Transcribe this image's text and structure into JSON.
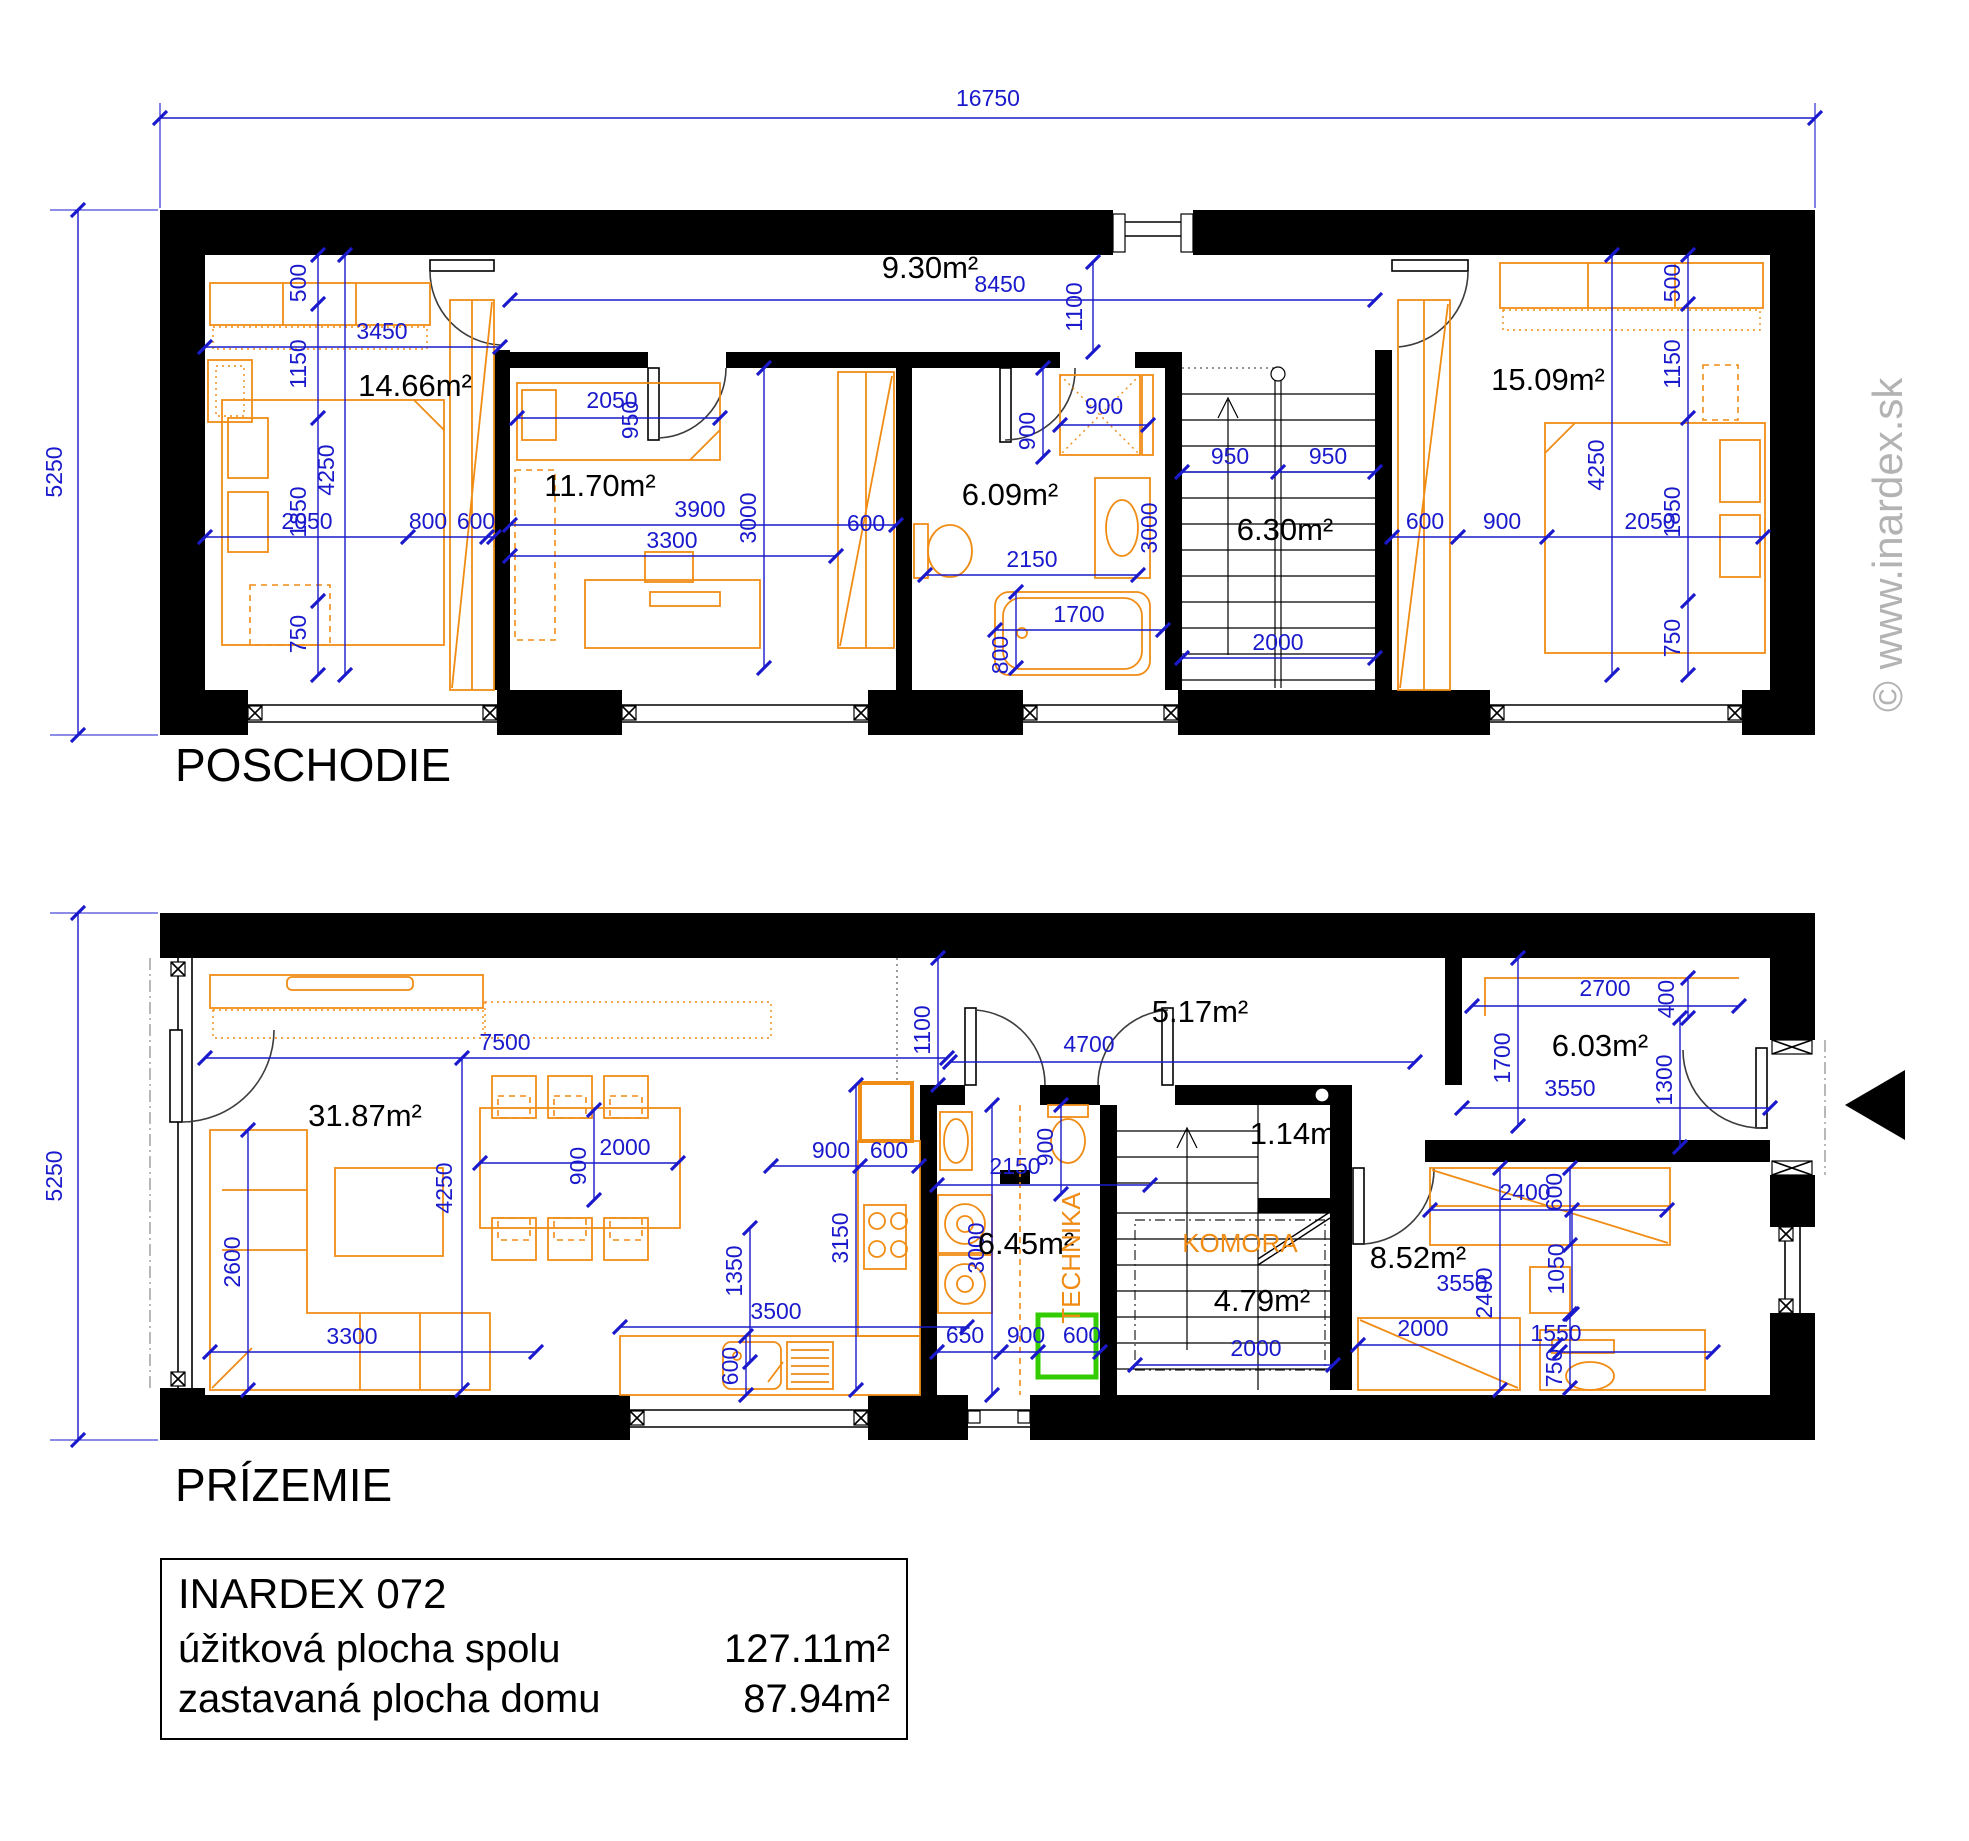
{
  "page": {
    "watermark": "© www.inardex.sk",
    "colors": {
      "dimension_blue": "#1a1acc",
      "furniture_orange": "#f08c14",
      "highlight_green": "#33cc00",
      "wall_black": "#000000",
      "watermark_gray": "#b3b3b3"
    }
  },
  "title_block": {
    "project": "INARDEX 072",
    "rows": [
      {
        "label": "úžitková plocha spolu",
        "value": "127.11m²"
      },
      {
        "label": "zastavaná plocha domu",
        "value": "87.94m²"
      }
    ]
  },
  "floors": [
    {
      "name": "POSCHODIE",
      "overall_width": "16750",
      "overall_depth": "5250",
      "area_labels": [
        {
          "t": "14.66m²",
          "x": 415,
          "y": 396
        },
        {
          "t": "9.30m²",
          "x": 930,
          "y": 278
        },
        {
          "t": "11.70m²",
          "x": 600,
          "y": 496
        },
        {
          "t": "6.09m²",
          "x": 1010,
          "y": 505
        },
        {
          "t": "6.30m²",
          "x": 1285,
          "y": 540
        },
        {
          "t": "15.09m²",
          "x": 1548,
          "y": 390
        }
      ],
      "dim_labels": [
        {
          "t": "16750",
          "x": 988,
          "y": 106
        },
        {
          "t": "5250",
          "x": 62,
          "y": 472,
          "r": -90
        },
        {
          "t": "8450",
          "x": 1000,
          "y": 292
        },
        {
          "t": "1100",
          "x": 1082,
          "y": 307,
          "r": -90
        },
        {
          "t": "3450",
          "x": 382,
          "y": 339
        },
        {
          "t": "500",
          "x": 306,
          "y": 283,
          "r": -90
        },
        {
          "t": "1150",
          "x": 306,
          "y": 364,
          "r": -90
        },
        {
          "t": "4250",
          "x": 334,
          "y": 470,
          "r": -90
        },
        {
          "t": "1850",
          "x": 306,
          "y": 512,
          "r": -90
        },
        {
          "t": "750",
          "x": 306,
          "y": 634,
          "r": -90
        },
        {
          "t": "2050",
          "x": 307,
          "y": 529
        },
        {
          "t": "800",
          "x": 428,
          "y": 529
        },
        {
          "t": "600",
          "x": 476,
          "y": 529
        },
        {
          "t": "2050",
          "x": 612,
          "y": 408
        },
        {
          "t": "950",
          "x": 638,
          "y": 420,
          "r": -90
        },
        {
          "t": "3900",
          "x": 700,
          "y": 517
        },
        {
          "t": "3300",
          "x": 672,
          "y": 548
        },
        {
          "t": "3000",
          "x": 756,
          "y": 518,
          "r": -90
        },
        {
          "t": "600",
          "x": 866,
          "y": 531
        },
        {
          "t": "900",
          "x": 1104,
          "y": 414
        },
        {
          "t": "900",
          "x": 1035,
          "y": 431,
          "r": -90
        },
        {
          "t": "2150",
          "x": 1032,
          "y": 567
        },
        {
          "t": "3000",
          "x": 1157,
          "y": 528,
          "r": -90
        },
        {
          "t": "1700",
          "x": 1079,
          "y": 622
        },
        {
          "t": "800",
          "x": 1008,
          "y": 655,
          "r": -90
        },
        {
          "t": "950",
          "x": 1230,
          "y": 464
        },
        {
          "t": "950",
          "x": 1328,
          "y": 464
        },
        {
          "t": "2000",
          "x": 1278,
          "y": 650
        },
        {
          "t": "600",
          "x": 1425,
          "y": 529
        },
        {
          "t": "900",
          "x": 1502,
          "y": 529
        },
        {
          "t": "2050",
          "x": 1650,
          "y": 529
        },
        {
          "t": "4250",
          "x": 1604,
          "y": 465,
          "r": -90
        },
        {
          "t": "500",
          "x": 1680,
          "y": 283,
          "r": -90
        },
        {
          "t": "1150",
          "x": 1680,
          "y": 364,
          "r": -90
        },
        {
          "t": "1850",
          "x": 1680,
          "y": 512,
          "r": -90
        },
        {
          "t": "750",
          "x": 1680,
          "y": 638,
          "r": -90
        }
      ],
      "feature_labels": []
    },
    {
      "name": "PRÍZEMIE",
      "overall_depth": "5250",
      "area_labels": [
        {
          "t": "31.87m²",
          "x": 365,
          "y": 1126
        },
        {
          "t": "5.17m²",
          "x": 1200,
          "y": 1022
        },
        {
          "t": "6.03m²",
          "x": 1600,
          "y": 1056
        },
        {
          "t": "1.14m²",
          "x": 1298,
          "y": 1144
        },
        {
          "t": "6.45m²",
          "x": 1026,
          "y": 1254
        },
        {
          "t": "4.79m²",
          "x": 1262,
          "y": 1311
        },
        {
          "t": "8.52m²",
          "x": 1418,
          "y": 1268
        }
      ],
      "dim_labels": [
        {
          "t": "5250",
          "x": 62,
          "y": 1176,
          "r": -90
        },
        {
          "t": "7500",
          "x": 505,
          "y": 1050
        },
        {
          "t": "4250",
          "x": 452,
          "y": 1188,
          "r": -90
        },
        {
          "t": "2600",
          "x": 240,
          "y": 1262,
          "r": -90
        },
        {
          "t": "3300",
          "x": 352,
          "y": 1344
        },
        {
          "t": "2000",
          "x": 625,
          "y": 1155
        },
        {
          "t": "900",
          "x": 586,
          "y": 1166,
          "r": -90
        },
        {
          "t": "1350",
          "x": 742,
          "y": 1271,
          "r": -90
        },
        {
          "t": "3150",
          "x": 848,
          "y": 1238,
          "r": -90
        },
        {
          "t": "3500",
          "x": 776,
          "y": 1319
        },
        {
          "t": "600",
          "x": 738,
          "y": 1366,
          "r": -90
        },
        {
          "t": "900",
          "x": 831,
          "y": 1158
        },
        {
          "t": "600",
          "x": 889,
          "y": 1158
        },
        {
          "t": "1100",
          "x": 930,
          "y": 1030,
          "r": -90
        },
        {
          "t": "4700",
          "x": 1089,
          "y": 1052
        },
        {
          "t": "2150",
          "x": 1015,
          "y": 1174
        },
        {
          "t": "900",
          "x": 1053,
          "y": 1147,
          "r": -90
        },
        {
          "t": "3000",
          "x": 984,
          "y": 1248,
          "r": -90
        },
        {
          "t": "650",
          "x": 965,
          "y": 1343
        },
        {
          "t": "900",
          "x": 1026,
          "y": 1343
        },
        {
          "t": "600",
          "x": 1082,
          "y": 1343
        },
        {
          "t": "2000",
          "x": 1256,
          "y": 1356
        },
        {
          "t": "2700",
          "x": 1605,
          "y": 996
        },
        {
          "t": "400",
          "x": 1674,
          "y": 999,
          "r": -90
        },
        {
          "t": "1700",
          "x": 1510,
          "y": 1058,
          "r": -90
        },
        {
          "t": "1300",
          "x": 1672,
          "y": 1080,
          "r": -90
        },
        {
          "t": "3550",
          "x": 1570,
          "y": 1096
        },
        {
          "t": "2400",
          "x": 1525,
          "y": 1200
        },
        {
          "t": "600",
          "x": 1562,
          "y": 1192,
          "r": -90
        },
        {
          "t": "3550",
          "x": 1462,
          "y": 1291
        },
        {
          "t": "2400",
          "x": 1492,
          "y": 1293,
          "r": -90
        },
        {
          "t": "1050",
          "x": 1564,
          "y": 1269,
          "r": -90
        },
        {
          "t": "2000",
          "x": 1423,
          "y": 1336
        },
        {
          "t": "1550",
          "x": 1556,
          "y": 1341
        },
        {
          "t": "750",
          "x": 1562,
          "y": 1368,
          "r": -90
        }
      ],
      "feature_labels": [
        {
          "t": "KOMORA",
          "x": 1240,
          "y": 1252
        },
        {
          "t": "TECHNIKA",
          "x": 1080,
          "y": 1258,
          "r": -90
        }
      ]
    }
  ]
}
